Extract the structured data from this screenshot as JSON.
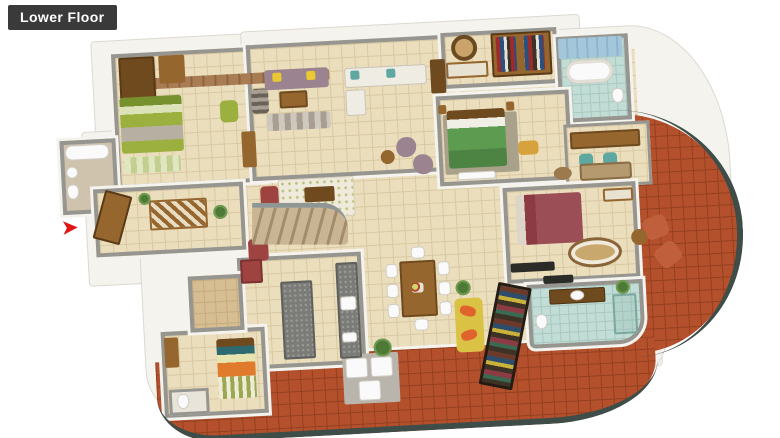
{
  "header": {
    "title": "Lower Floor"
  },
  "icons": {
    "entry_arrow_glyph": "➤"
  },
  "scene": {
    "type": "3d-isometric-floorplan-render",
    "entry": {
      "indicator": "red-arrow",
      "direction": "right"
    },
    "areas": [
      "master-bedroom-olive",
      "en-suite-bathroom",
      "store-room",
      "foyer-entry",
      "living-room-mauve-sofas",
      "lounge-white-sofa",
      "dressing-room-wardrobes",
      "blue-tile-bathroom",
      "bedroom-green-bed",
      "study-desk-area",
      "bedroom-maroon-bed",
      "round-sitout-balcony",
      "staircase",
      "family-rug-area",
      "kitchen-with-island",
      "dining-eight-seater",
      "maid-room-orange-bed",
      "maid-toilet",
      "utility-laundry",
      "library-bookshelf",
      "yellow-reading-bench",
      "teal-bathroom",
      "wrap-around-terracotta-balcony",
      "glass-window-band"
    ]
  },
  "colors": {
    "page_bg": "#ffffff",
    "badge_bg": "#3a3a3a",
    "badge_text": "#ffffff",
    "wall_top": "#979590",
    "wall_side": "#f5f3ed",
    "floor_cream": "#ebdebd",
    "floor_line": "#d9c9a2",
    "floor_tan": "#d6bd92",
    "terracotta": "#b5502d",
    "terracotta_line": "#93401f",
    "railing": "#3e4d48",
    "olive": "#9cb03f",
    "olive_dark": "#77912e",
    "mauve": "#9b8490",
    "sofa_white": "#efece3",
    "yellow": "#e9c832",
    "wood": "#96662f",
    "wood_dark": "#6f4a1f",
    "green_bed": "#5c9b50",
    "maroon": "#9c4e56",
    "teal": "#5fa8a1",
    "blue_tile": "#a3c6da",
    "teal_floor": "#c2ddd6",
    "orange": "#e07b2d",
    "bench_yellow": "#d9c244",
    "pillow_orange": "#e0622c",
    "shelf_dark": "#3c3226",
    "granite": "#7b7b78",
    "red_cabinet": "#9e4340",
    "rug_tan": "#c8a86d",
    "rug_light": "#efeadc",
    "arrow_red": "#e01616",
    "white_fix": "#fafafa"
  }
}
